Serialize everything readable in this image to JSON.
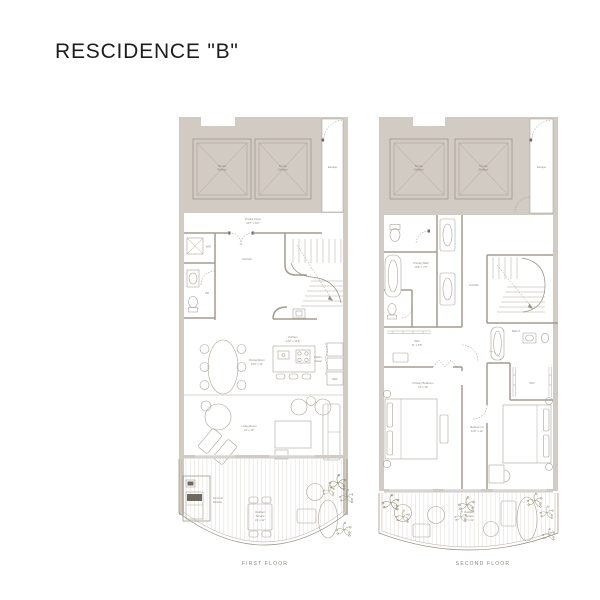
{
  "title": "RESCIDENCE \"B\"",
  "colors": {
    "background": "#ffffff",
    "wall_fill": "#d2cbc4",
    "line": "#968e81",
    "label_text": "#8d8578",
    "plant_green": "#8e9173",
    "title_text": "#1d1d1b"
  },
  "ff": {
    "caption": "FIRST FLOOR",
    "elevator": {
      "line1": "Private",
      "line2": "Elevator"
    },
    "escape": "Escape",
    "foyer": {
      "name": "Private Foyer",
      "dims": "20'7\" x 6'2\""
    },
    "wd": "W/D",
    "powder": "PR",
    "corridor": "Corridor",
    "kitchen": {
      "name": "Kitchen",
      "dims": "14'2\" x 12'8\""
    },
    "pantry": {
      "line1": "Pantry",
      "line2": "Closet"
    },
    "ref": "REF",
    "dining": {
      "name": "Dining Room",
      "dims": "11'6\" x 21'"
    },
    "living": {
      "name": "Living Room",
      "dims": "21' x 15'"
    },
    "summer_kitchen": {
      "line1": "Summer",
      "line2": "Kitchen"
    },
    "terrace": {
      "line1": "Outdoor",
      "line2": "Terrace",
      "dims": "21' x 12'"
    }
  },
  "sf": {
    "caption": "SECOND FLOOR",
    "elevator": {
      "line1": "Private",
      "line2": "Elevator"
    },
    "escape": "Escape",
    "primary_bath": {
      "name": "Primary Bath",
      "dims": "13'6\" x 7'5\""
    },
    "corridor": "Corridor",
    "bath2": "Bath 2",
    "wic1": {
      "name": "WIC",
      "dims": "11' x 5'9\""
    },
    "wic2": "WIC",
    "primary_bedroom": {
      "name": "Primary Bedroom",
      "dims": "14' x 16'"
    },
    "bedroom2": {
      "name": "Bedroom 2",
      "dims": "11'6\" x 12'"
    },
    "terrace": {
      "line1": "Outdoor",
      "line2": "Terrace",
      "dims": "21' x 12'"
    }
  }
}
